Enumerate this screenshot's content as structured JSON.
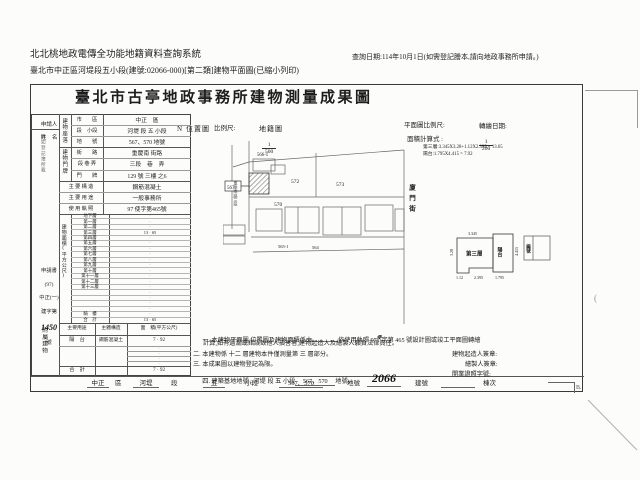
{
  "header": {
    "system_title": "北北桃地政電傳全功能地籍資料查詢系統",
    "query_date": "查詢日期:114年10月1日(如需登記謄本,請向地政事務所申請。)",
    "doc_line": "臺北市中正區河堤段五小段(建號:02066-000)[第二類]建物平面圖(已縮小列印)"
  },
  "form": {
    "title": "臺北市古亭地政事務所建物測量成果圖",
    "maps_header": {
      "north": "N",
      "location_label": "位置圖",
      "scale_label": "比例尺:",
      "location_scale_num": "1",
      "location_scale_den": "500",
      "cadastral_label": "地籍圖",
      "plan_scale_label": "平面圖比例尺:",
      "plan_scale_num": "1",
      "plan_scale_den": "200",
      "redraw_label": "轉繪日期:",
      "calc_title": "面積計算式 :",
      "calc_line1": "第三層:3.345X3.28+1.12X2.395 = 13.65",
      "calc_line2": "陽台:1.795X4.415 = 7.92"
    },
    "applicant": {
      "label_line1": "申請人",
      "label_line2": "姓　名",
      "note": "詳如登記簿所載"
    },
    "application_no": {
      "line1": "申請書",
      "line2": "(97)",
      "line3": "中正(一)",
      "line4": "建字第",
      "number": "1450",
      "line5": "號"
    },
    "seat": {
      "group": "建物座落",
      "rows": [
        {
          "label": "市　　區",
          "value": "中正　區"
        },
        {
          "label": "段　小段",
          "value": "河堤 段 五 小段"
        },
        {
          "label": "地　　號",
          "value": "567、570 地號"
        }
      ]
    },
    "door": {
      "group": "建物門牌",
      "rows": [
        {
          "label": "街　　路",
          "value": "重慶南 街路"
        },
        {
          "label": "段 巷 弄",
          "value": "三段　巷　弄"
        },
        {
          "label": "門　　牌",
          "value": "129 號 三樓 之6"
        }
      ]
    },
    "info_rows": [
      {
        "label": "主 要 構 造",
        "value": "鋼筋混凝土"
      },
      {
        "label": "主 要 用 途",
        "value": "一般事務所"
      },
      {
        "label": "使 用 執 照",
        "value": "97 使字第465號"
      }
    ],
    "area": {
      "group_label": "建物面積(平方公尺)",
      "rows": [
        {
          "label": "地下層",
          "value": "·"
        },
        {
          "label": "第一層",
          "value": "·"
        },
        {
          "label": "第二層",
          "value": "·"
        },
        {
          "label": "第三層",
          "value": "13 · 65"
        },
        {
          "label": "第四層",
          "value": "·"
        },
        {
          "label": "第五層",
          "value": "·"
        },
        {
          "label": "第六層",
          "value": "·"
        },
        {
          "label": "第七層",
          "value": "·"
        },
        {
          "label": "第八層",
          "value": "·"
        },
        {
          "label": "第九層",
          "value": "·"
        },
        {
          "label": "第十層",
          "value": "·"
        },
        {
          "label": "第十一層",
          "value": "·"
        },
        {
          "label": "第十二層",
          "value": "·"
        },
        {
          "label": "第十三層",
          "value": "·"
        },
        {
          "label": "",
          "value": "·"
        },
        {
          "label": "",
          "value": "·"
        },
        {
          "label": "",
          "value": "·"
        },
        {
          "label": "",
          "value": "·"
        },
        {
          "label": "騎　樓",
          "value": "·"
        },
        {
          "label": "合　計",
          "value": "13 · 65"
        }
      ]
    },
    "attached": {
      "group_label": "附屬建物",
      "header_use": "主要用途",
      "header_structure": "主體構造",
      "header_area": "面　積(平方公尺)",
      "row_use": "陽　台",
      "row_structure": "鋼筋混凝土",
      "row_area": "7 · 92",
      "filler": "·",
      "total_label": "合　計",
      "total_area": "7 · 92"
    },
    "bottom_strip": {
      "district": "中正",
      "district_unit": "區",
      "section": "河堤",
      "section_unit": "段",
      "subsection": "五",
      "subsection_unit": "小段",
      "parcels": "567、570",
      "parcel_unit": "地號",
      "building_no": "2066",
      "building_unit": "建號",
      "block_unit": "棟次",
      "mark": "B."
    },
    "notes": {
      "n1a": "一. 本建物平面圖,位置圖及建物面積係由",
      "n1b_pre": "依使用執照 97",
      "n1_insert": "使",
      "n1b_post": "字第 465 號設計圖或竣工平面圖轉繪",
      "n1c": "計算,如有遺漏或錯誤致他人損害者,建物起造人及繪製人願負法律責任。",
      "n2": "二. 本建物係 十二 層建物本件僅測量第 三 層部分。",
      "n3": "三. 本成果圖以建物登記為限。",
      "n4a": "四. 建築基地地號 : 河堤 段 五 小段",
      "n4b": "567、570",
      "n4c": "地號。",
      "sign_builder": "建物起造人簽章:",
      "sign_drafter": "繪製人簽章:",
      "sign_license": "開業證照字號:"
    },
    "location_map": {
      "parcel_566": "566-1",
      "parcel_567": "567",
      "parcel_570": "570",
      "parcel_572": "572",
      "parcel_573": "573",
      "parcel_565": "565-1",
      "parcel_564": "564",
      "street_left": "重慶南路三段",
      "street_right": "廈門街"
    },
    "floor_plan": {
      "room": "第三層",
      "balcony": "陽台",
      "dim_top": "3.345",
      "dim_left": "3.28",
      "dim_step": "1.12",
      "dim_bottom": "2.395",
      "dim_balcony_bottom": "1.795",
      "dim_balcony_right": "4.415",
      "index_label": "編號"
    }
  }
}
